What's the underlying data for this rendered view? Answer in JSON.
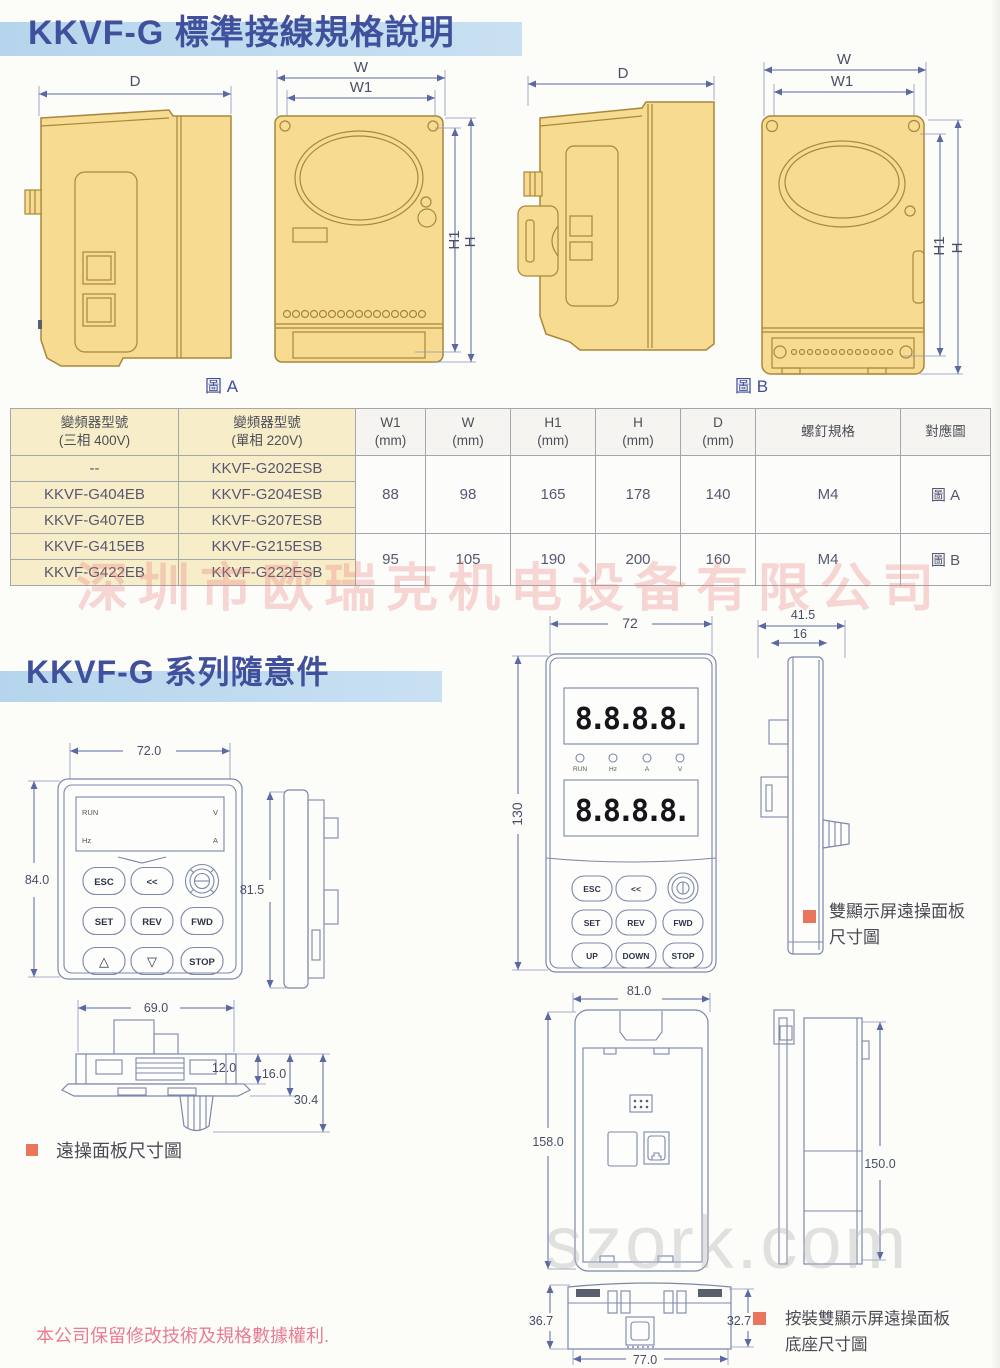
{
  "page": {
    "title1": "KKVF-G 標準接線規格說明",
    "title2": "KKVF-G 系列隨意件",
    "footer_note": "本公司保留修改技術及規格數據權利.",
    "watermark_company": "深圳市欧瑞克机电设备有限公司",
    "watermark_site": "szork.com"
  },
  "dim_labels": {
    "d": "D",
    "w": "W",
    "w1": "W1",
    "h1": "H1",
    "h": "H"
  },
  "fig_a": {
    "label": "圖 A"
  },
  "fig_b": {
    "label": "圖 B"
  },
  "spec_table": {
    "headers": [
      {
        "line1": "變頻器型號",
        "line2": "(三相 400V)"
      },
      {
        "line1": "變頻器型號",
        "line2": "(單相 220V)"
      },
      {
        "line1": "W1",
        "line2": "(mm)"
      },
      {
        "line1": "W",
        "line2": "(mm)"
      },
      {
        "line1": "H1",
        "line2": "(mm)"
      },
      {
        "line1": "H",
        "line2": "(mm)"
      },
      {
        "line1": "D",
        "line2": "(mm)"
      },
      {
        "line1": "螺釘規格",
        "line2": ""
      },
      {
        "line1": "對應圖",
        "line2": ""
      }
    ],
    "model_rows": [
      [
        "--",
        "KKVF-G202ESB"
      ],
      [
        "KKVF-G404EB",
        "KKVF-G204ESB"
      ],
      [
        "KKVF-G407EB",
        "KKVF-G207ESB"
      ],
      [
        "KKVF-G415EB",
        "KKVF-G215ESB"
      ],
      [
        "KKVF-G422EB",
        "KKVF-G222ESB"
      ]
    ],
    "group_a": {
      "w1": "88",
      "w": "98",
      "h1": "165",
      "h": "178",
      "d": "140",
      "screw": "M4",
      "fig": "圖 A"
    },
    "group_b": {
      "w1": "95",
      "w": "105",
      "h1": "190",
      "h": "200",
      "d": "160",
      "screw": "M4",
      "fig": "圖 B"
    }
  },
  "panel_small": {
    "front": {
      "dim_w": "72.0",
      "dim_h": "84.0"
    },
    "side": {
      "dim_h": "81.5"
    },
    "bottom": {
      "dim_w": "69.0",
      "dim_a": "12.0",
      "dim_b": "16.0",
      "dim_c": "30.4"
    },
    "display": {
      "run": "RUN",
      "hz": "Hz",
      "v": "V",
      "a": "A"
    },
    "buttons": {
      "esc": "ESC",
      "back": "<<",
      "set": "SET",
      "rev": "REV",
      "fwd": "FWD",
      "up": "△",
      "down": "▽",
      "stop": "STOP"
    },
    "caption": "遠操面板尺寸圖"
  },
  "panel_dual": {
    "front": {
      "dim_w": "72",
      "dim_h": "130"
    },
    "side": {
      "dim_a": "41.5",
      "dim_b": "16"
    },
    "display_value": "8.8.8.8.",
    "leds": [
      "RUN",
      "Hz",
      "A",
      "V"
    ],
    "buttons": {
      "esc": "ESC",
      "back": "<<",
      "set": "SET",
      "rev": "REV",
      "fwd": "FWD",
      "up": "UP",
      "down": "DOWN",
      "stop": "STOP"
    },
    "caption_line1": "雙顯示屏遠操面板",
    "caption_line2": "尺寸圖"
  },
  "base_mount": {
    "front": {
      "dim_w": "81.0",
      "dim_h": "158.0"
    },
    "side": {
      "dim_h": "150.0"
    },
    "bottom": {
      "dim_w": "77.0",
      "dim_left": "36.7",
      "dim_right": "32.7"
    },
    "caption_line1": "按裝雙顯示屏遠操面板",
    "caption_line2": "底座尺寸圖"
  }
}
